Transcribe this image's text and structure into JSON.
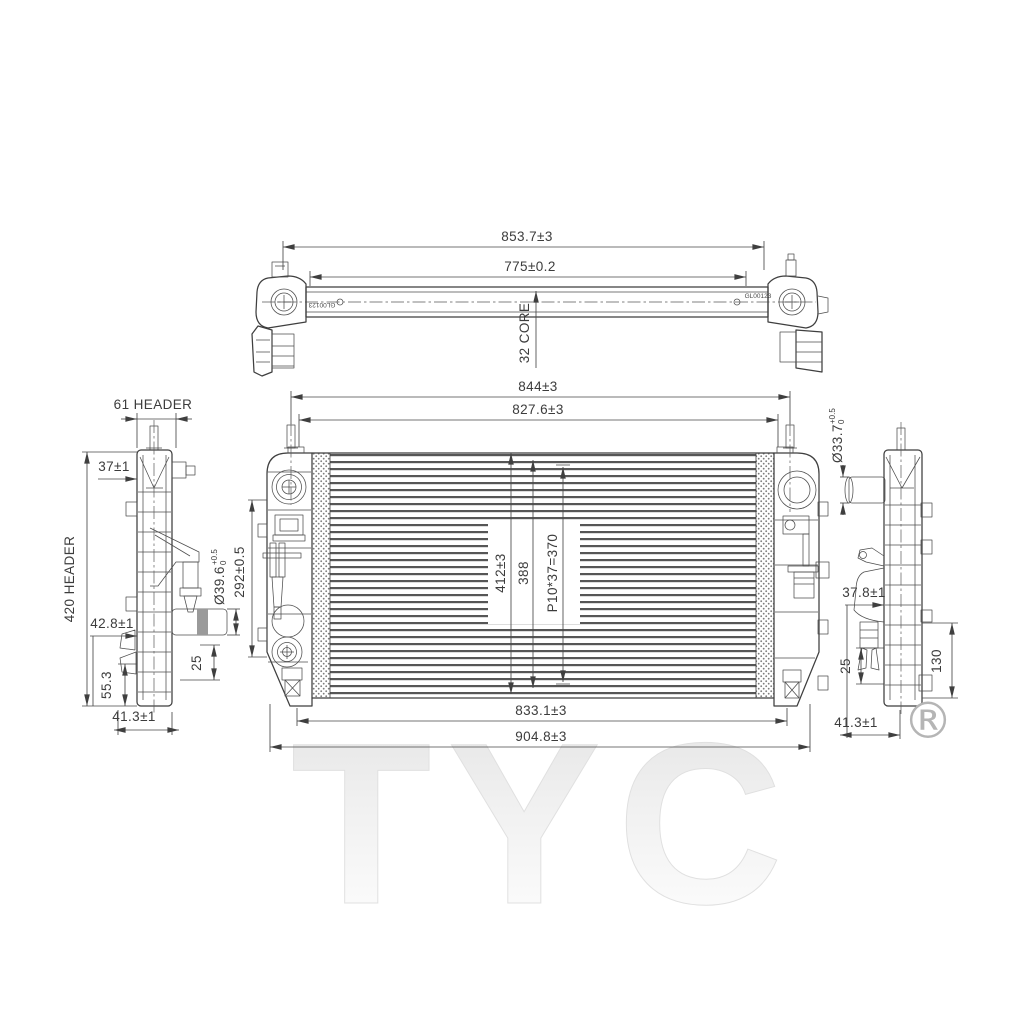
{
  "title": "Radiator technical line drawing",
  "watermark": {
    "brand": "TYC",
    "registered": "®"
  },
  "top_view": {
    "dim_overall_width": "853.7±3",
    "dim_core_width": "775±0.2",
    "core_label": "32 CORE",
    "stamp_left": "GL00123",
    "stamp_right": "GL00123"
  },
  "front_view": {
    "dim_width_outer": "844±3",
    "dim_width_inner": "827.6±3",
    "dim_core_height": "412±3",
    "dim_tank_height": "388",
    "dim_tube_pitch": "P10*37=370",
    "dim_left_height": "292±0.5",
    "dim_width_lower": "833.1±3",
    "dim_width_total": "904.8±3"
  },
  "left_side_view": {
    "dim_header_width": "61 HEADER",
    "dim_top_offset": "37±1",
    "dim_header_height": "420 HEADER",
    "dim_mid_offset": "42.8±1",
    "pipe_diameter": "Ø39.6",
    "pipe_tol_upper": "+0.5",
    "pipe_tol_lower": "0",
    "dim_lower_offset": "55.3",
    "dim_drain_offset": "25",
    "dim_bottom_offset": "41.3±1"
  },
  "right_side_view": {
    "pipe_diameter": "Ø33.7",
    "pipe_tol_upper": "+0.5",
    "pipe_tol_lower": "0",
    "dim_mid_offset": "37.8±1",
    "dim_drain_offset": "25",
    "dim_lower_height": "130",
    "dim_bottom_offset": "41.3±1"
  }
}
